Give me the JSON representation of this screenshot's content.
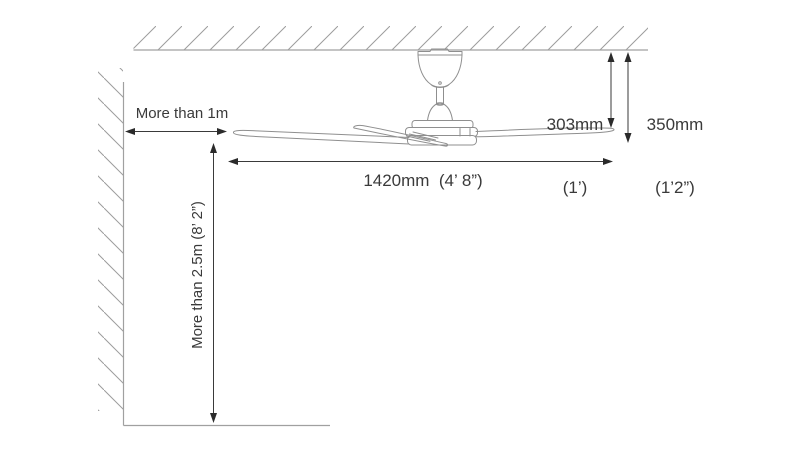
{
  "diagram": {
    "labels": {
      "wall_clearance": "More than 1m",
      "floor_clearance": "More than 2.5m (8’ 2”)",
      "blade_span": "1420mm  (4’ 8”)",
      "drop_height_value": "303mm",
      "drop_height_alt": "(1’)",
      "total_height_value": "350mm",
      "total_height_alt": "(1’2”)"
    },
    "colors": {
      "dimension_lines": "#3a3a3a",
      "artwork_lines": "#8f8f8f",
      "hatch_lines": "#9c9c9c",
      "background": "#ffffff"
    }
  }
}
